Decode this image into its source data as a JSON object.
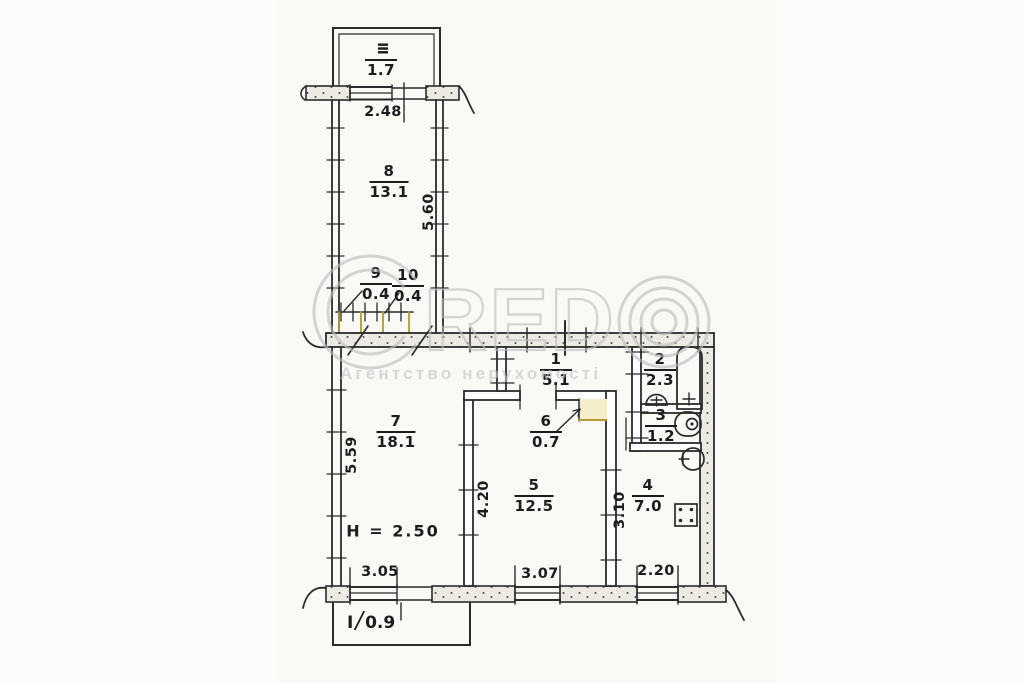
{
  "plan": {
    "rooms": {
      "balcony_top": {
        "num": "III",
        "area": "1.7"
      },
      "r8": {
        "num": "8",
        "area": "13.1"
      },
      "r9": {
        "num": "9",
        "area": "0.4"
      },
      "r10": {
        "num": "10",
        "area": "0.4"
      },
      "r1": {
        "num": "1",
        "area": "5.1"
      },
      "r2": {
        "num": "2",
        "area": "2.3"
      },
      "r3": {
        "num": "3",
        "area": "1.2"
      },
      "r4": {
        "num": "4",
        "area": "7.0"
      },
      "r5": {
        "num": "5",
        "area": "12.5"
      },
      "r6": {
        "num": "6",
        "area": "0.7"
      },
      "r7": {
        "num": "7",
        "area": "18.1"
      },
      "balcony_bottom": {
        "num": "I",
        "sep": "/",
        "area": "0.9"
      }
    },
    "dimensions": {
      "top": "2.48",
      "corridor": "5.60",
      "left": "5.59",
      "room5_side": "4.20",
      "kitchen_side": "3.10",
      "bottom_left": "3.05",
      "bottom_center": "3.07",
      "bottom_right": "2.20",
      "ceiling": "H = 2.50"
    },
    "ink_color": "#2b2b2b",
    "highlight_color": "#b19a2e"
  },
  "watermark": {
    "brand_letters": "RED",
    "subtitle": "Агентство нерухомості",
    "color": "#bdbdbd"
  }
}
